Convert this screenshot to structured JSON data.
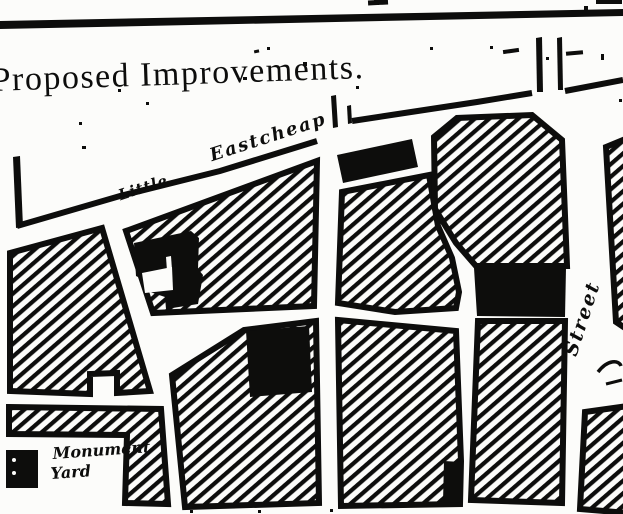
{
  "document": {
    "title": "Proposed Improvements."
  },
  "street_labels": {
    "little": "Little",
    "eastcheap": "Eastcheap",
    "right_street": "Street"
  },
  "legend": {
    "swatch_icon": "monument-yard-black-square",
    "line1": "Monument",
    "line2": "Yard"
  },
  "colors": {
    "ink": "#0d0d0c",
    "paper": "#fcfcfa"
  }
}
